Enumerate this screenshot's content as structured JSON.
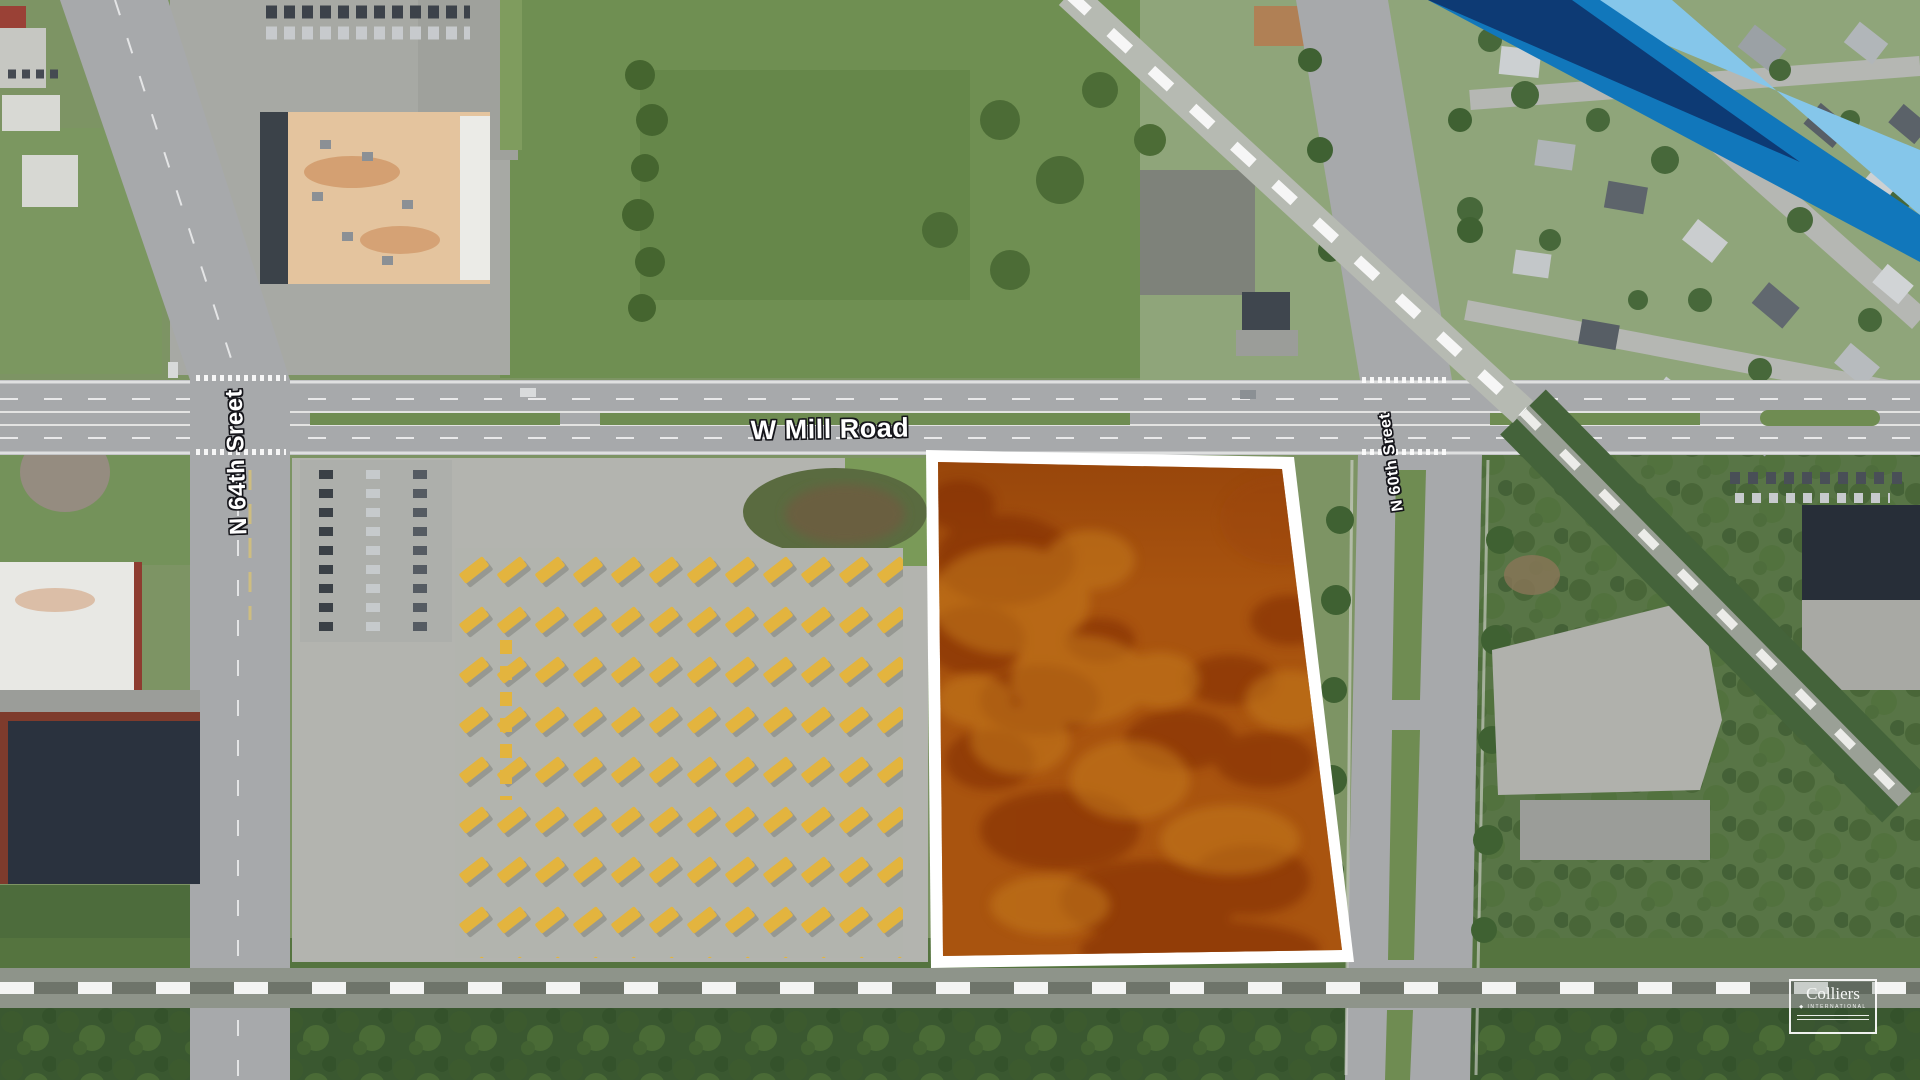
{
  "map": {
    "street_labels": {
      "mill": "W Mill Road",
      "n64": "N 64th Sreet",
      "n60": "N 60th Sreet"
    },
    "parcel": {
      "fill": "#a9540f",
      "border": "#ffffff"
    },
    "ribbon": {
      "navy": "#0d3a74",
      "blue": "#1177bb",
      "light_blue": "#85c6ea"
    }
  },
  "logo": {
    "brand": "Colliers",
    "bullet": "◆",
    "division": "INTERNATIONAL"
  }
}
